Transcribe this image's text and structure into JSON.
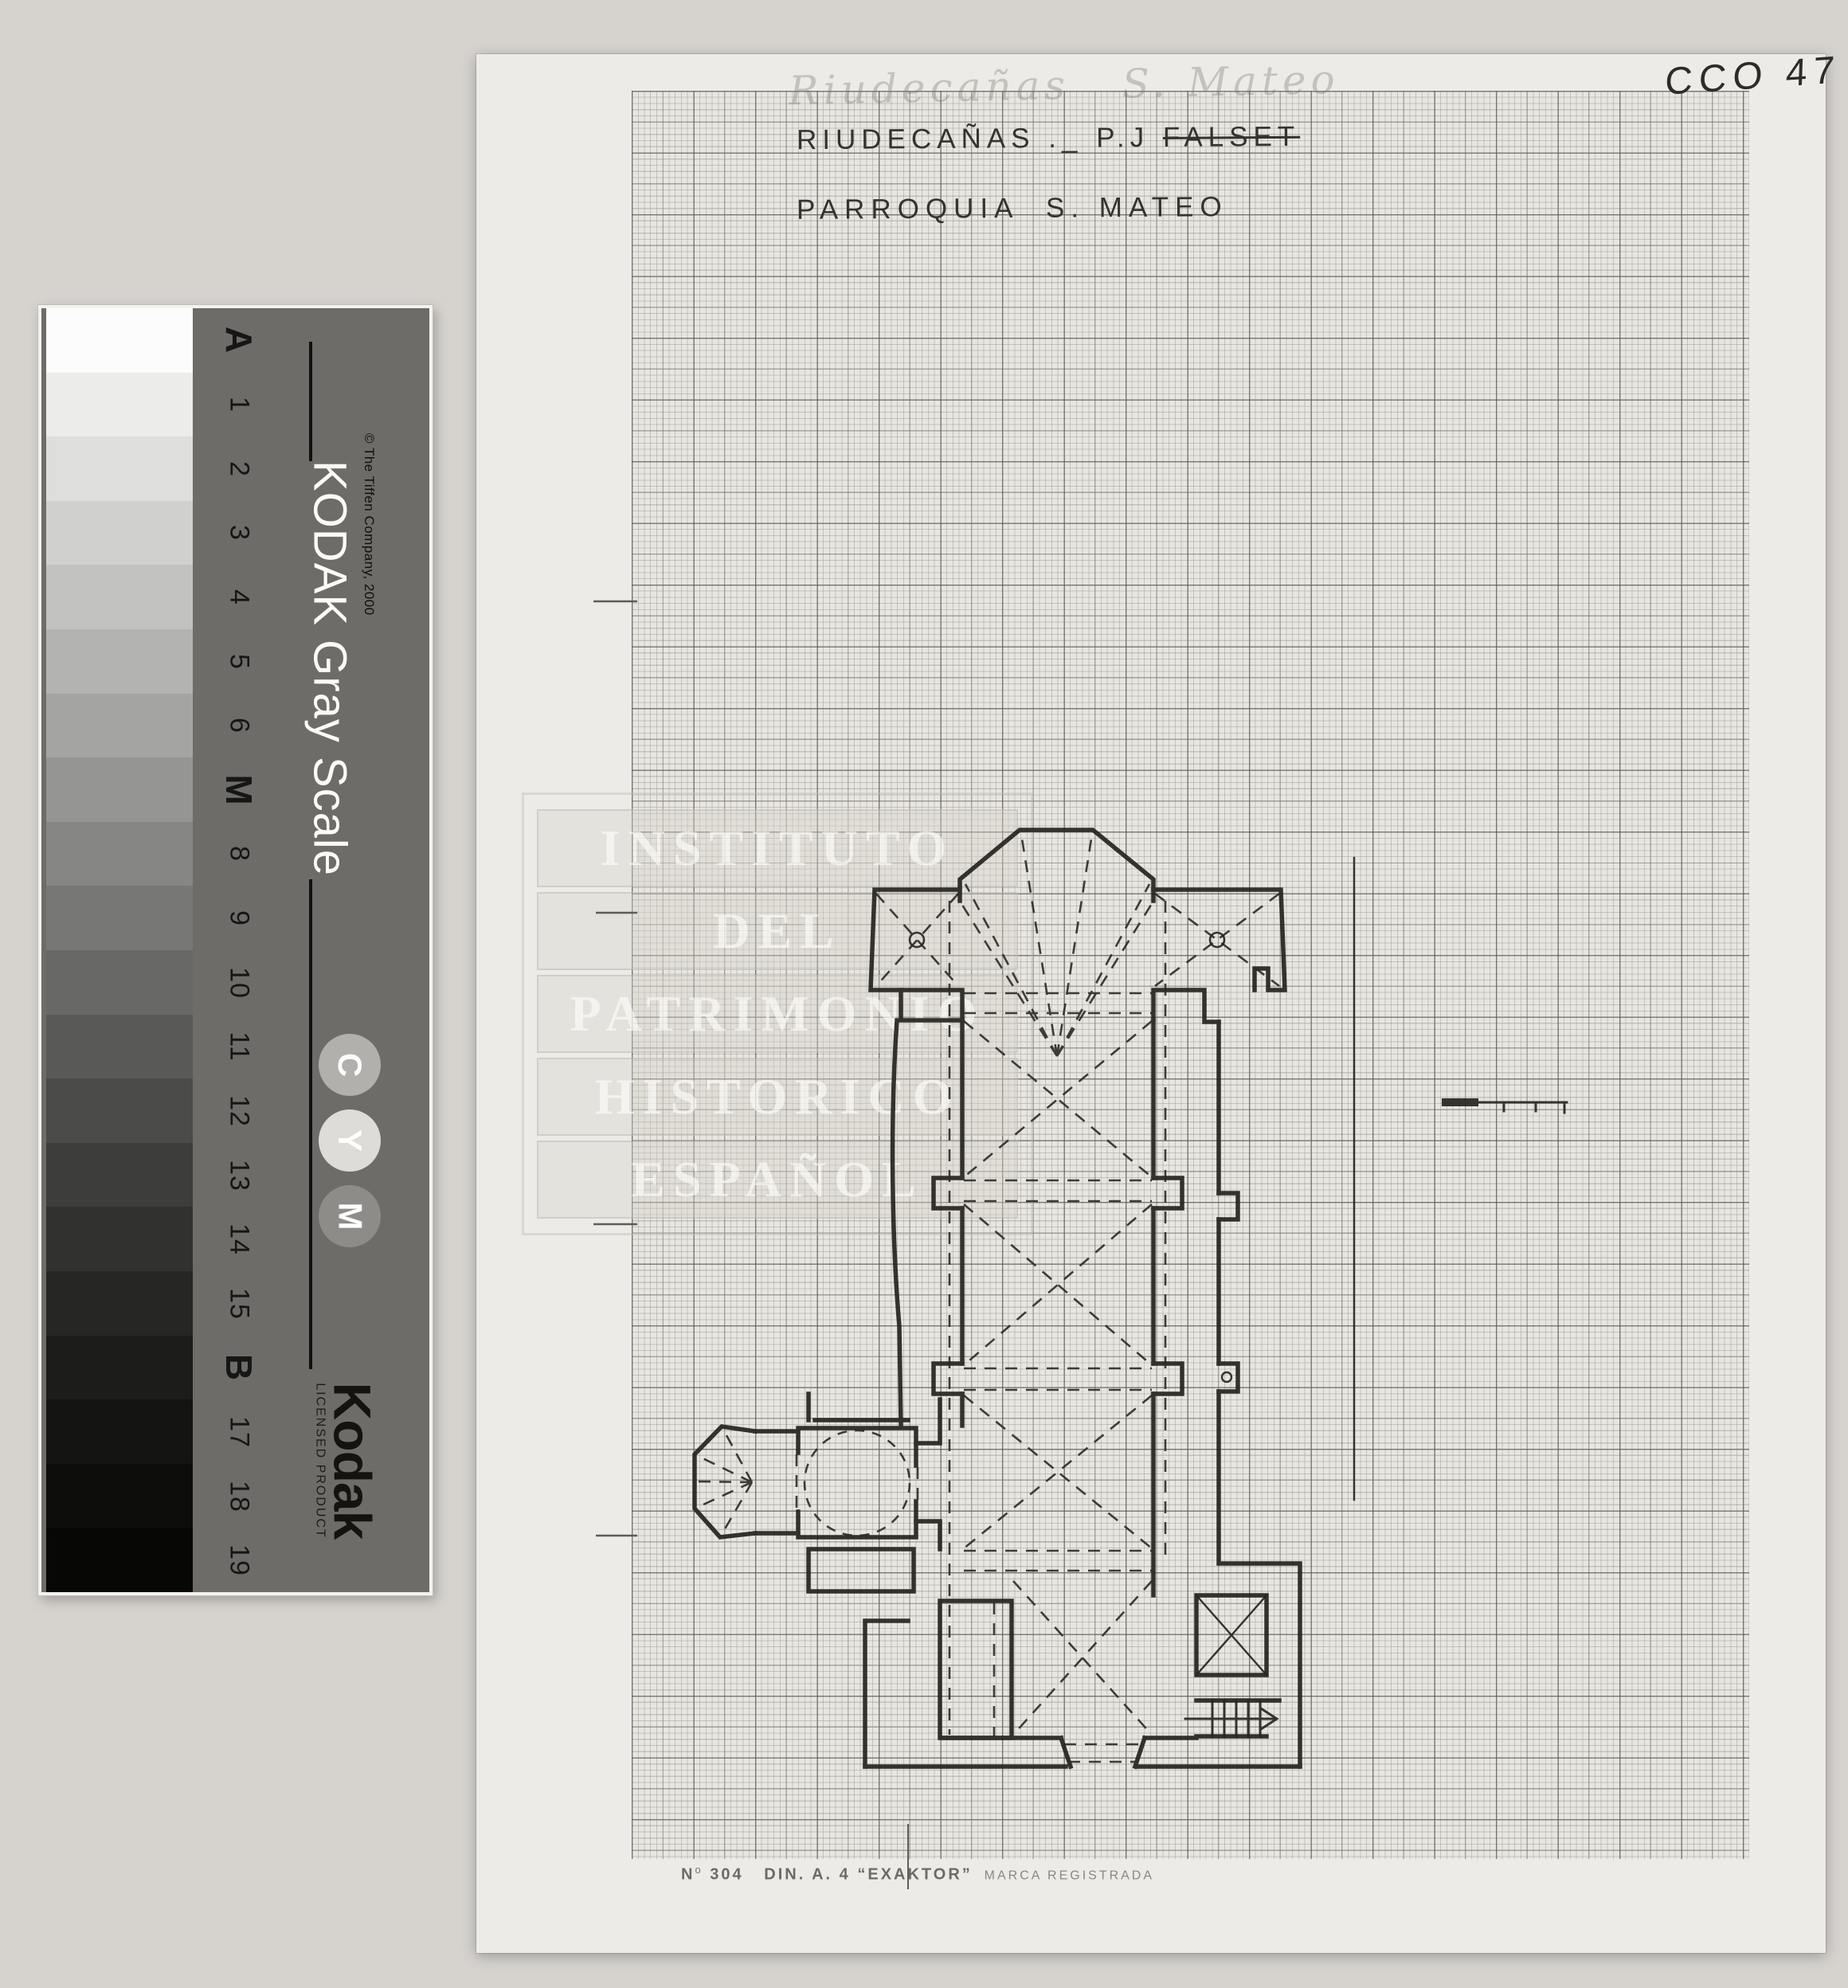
{
  "document": {
    "corner_code": "CCO 47",
    "faint_note": "Riudecañas   S. Mateo",
    "title_line1_prefix": "RIUDECAÑAS ._ P.J ",
    "title_line1_struck": "FALSET",
    "title_line2": "PARROQUIA  S. MATEO",
    "watermark_lines": [
      "INSTITUTO",
      "DEL",
      "PATRIMONIO",
      "HISTORICO",
      "ESPAÑOL"
    ],
    "footer": {
      "n": "N",
      "n_sup": "o",
      "number": " 304   ",
      "format": "DIN. A. 4 ",
      "brand": "“EXAKTOR”",
      "suffix": "  MARCA REGISTRADA"
    }
  },
  "gray_scale": {
    "copyright": "© The Tiffen Company, 2000",
    "title": "KODAK Gray Scale",
    "labels": [
      "A",
      "1",
      "2",
      "3",
      "4",
      "5",
      "6",
      "M",
      "8",
      "9",
      "10",
      "11",
      "12",
      "13",
      "14",
      "15",
      "B",
      "17",
      "18",
      "19"
    ],
    "cmy_circles": [
      "C",
      "Y",
      "M"
    ],
    "circle_colors": [
      "#b2b0ad",
      "#dedcd9",
      "#8e8c89"
    ],
    "brand": "Kodak",
    "licensed": "LICENSED PRODUCT",
    "patch_colors": [
      "#fcfcfc",
      "#ececeb",
      "#dededd",
      "#d0d0cf",
      "#c2c2c1",
      "#b3b3b2",
      "#a4a4a3",
      "#959594",
      "#868685",
      "#777776",
      "#686867",
      "#595958",
      "#4b4b4a",
      "#3d3d3c",
      "#313130",
      "#262625",
      "#1c1c1b",
      "#141413",
      "#0d0d0c",
      "#070706"
    ]
  },
  "colors": {
    "scanner_bg": "#d6d3cf",
    "paper": "#edebe7",
    "grid_area": "#e8e6e1",
    "grid_major": "#5f5b54",
    "ink": "#27251f",
    "pencil": "#34332f",
    "panel_gray": "#6e6c69"
  }
}
